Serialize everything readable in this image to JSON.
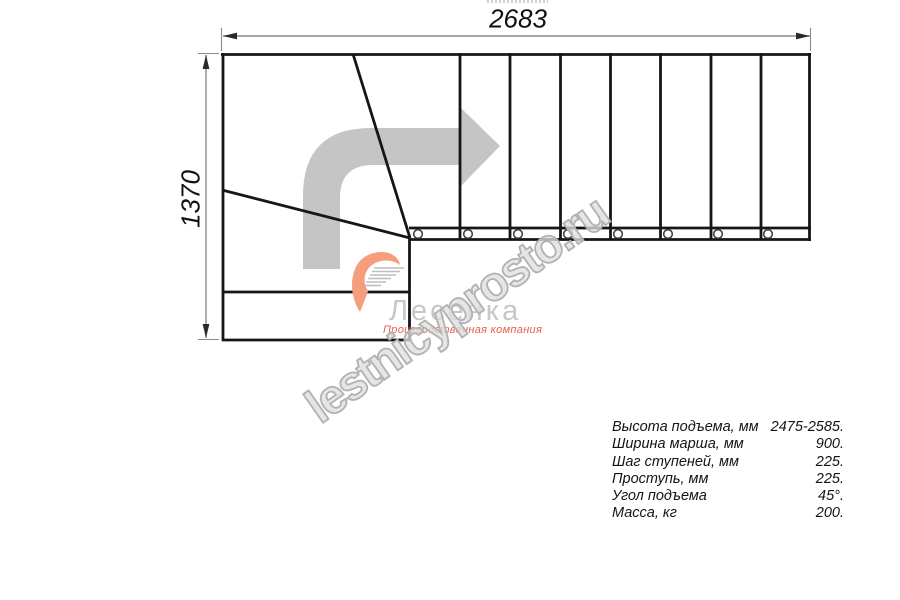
{
  "colors": {
    "line": "#161616",
    "dim": "#8a8a8a",
    "dim-arrow": "#2a2a2a",
    "arrow-gray": "#c5c5c5",
    "watermark-gray": "#b2b2b2",
    "logo-gray": "#c7c7c7",
    "logo-orange": "#e5604a",
    "swoosh-salmon": "#f59d7d",
    "swoosh-steps": "#bdbdbd"
  },
  "dimensions": {
    "width": "2683",
    "height": "1370"
  },
  "watermark": {
    "text": "lestnicyprosto.ru"
  },
  "logo": {
    "name": "Лесенка",
    "tagline": "Производственная компания"
  },
  "specs": {
    "rows": [
      {
        "label": "Высота подъема, мм",
        "value": "2475-2585."
      },
      {
        "label": "Ширина марша, мм",
        "value": "900."
      },
      {
        "label": "Шаг ступеней, мм",
        "value": "225."
      },
      {
        "label": "Проступь, мм",
        "value": "225."
      },
      {
        "label": "Угол подъема",
        "value": "45°."
      },
      {
        "label": "Масса, кг",
        "value": "200."
      }
    ]
  }
}
